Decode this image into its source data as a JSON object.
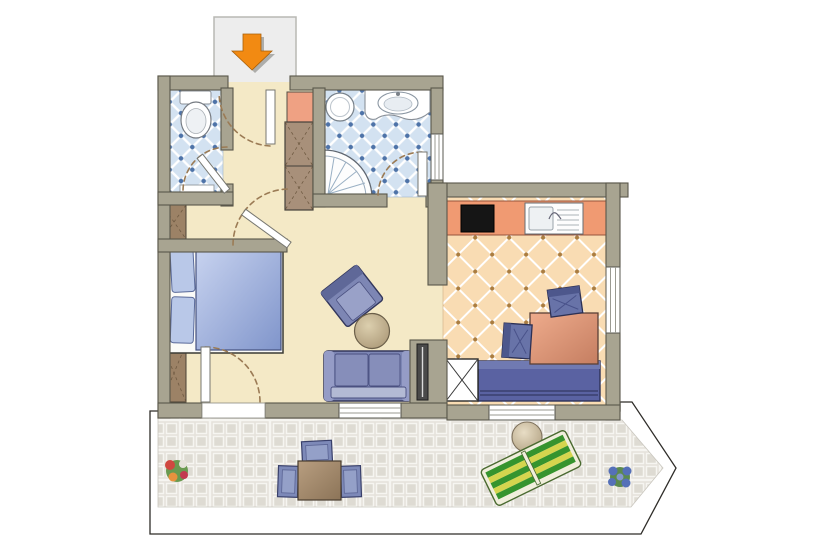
{
  "page": {
    "kind": "apartment-floor-plan",
    "background": "#ffffff"
  },
  "colors": {
    "wall": "#a8a491",
    "wall_edge": "#59574a",
    "floor_main": "#f4e9c6",
    "tile_blue": "#d3e2f1",
    "tile_blue_dot": "#4e73a8",
    "kitchen_floor": "#f9dcb3",
    "kitchen_dot": "#aa7d41",
    "terrace_tile": "#e5e2db",
    "terrace_grout": "#f6f5f1",
    "furniture_blue": "#7d86b4",
    "furniture_blue_dark": "#33375c",
    "bed_blue": "#9cadd9",
    "pillow_blue": "#b9c8e8",
    "closet_salmon": "#efa183",
    "counter_salmon": "#f09a72",
    "dining_table_salmon": "#d98e6d",
    "wood_brown": "#9c8266",
    "bench_blue": "#5a62a2",
    "lounger_green": "#36942e",
    "lounger_yellow": "#d4d54e",
    "arrow_orange": "#f28a12",
    "door_arc_brown": "#9b7b55",
    "radiator_gray": "#4a4a4a",
    "cooktop_black": "#151515",
    "fixture_white": "#ffffff",
    "plan_outline": "#2e2c28"
  },
  "entrance": {
    "icon": "entry-arrow-down-icon",
    "arrow_color": "#f28a12"
  },
  "rooms": [
    {
      "name": "wc",
      "floor": "blue-diamond-tile",
      "fixtures": [
        "toilet",
        "wall-shelf"
      ]
    },
    {
      "name": "hallway",
      "floor": "beige",
      "fixtures": [
        "closet-shelf",
        "wardrobe-cabinet"
      ]
    },
    {
      "name": "bathroom",
      "floor": "blue-diamond-tile",
      "fixtures": [
        "round-washbasin",
        "vanity-sink",
        "corner-shower"
      ]
    },
    {
      "name": "bedroom-living-studio",
      "floor": "beige",
      "furniture": [
        "wardrobe-upper",
        "wardrobe-lower",
        "double-bed",
        "pillow-left",
        "pillow-right",
        "armchair",
        "round-coffee-table",
        "two-seat-sofa",
        "radiator"
      ]
    },
    {
      "name": "kitchen-dining",
      "floor": "peach-diamond-tile",
      "furniture": [
        "kitchen-counter",
        "cooktop",
        "sink-with-drainer",
        "dining-table",
        "dining-chair-north",
        "dining-chair-west",
        "bench-daybed",
        "x-cabinet"
      ]
    },
    {
      "name": "terrace",
      "floor": "stone-pavers",
      "furniture": [
        "outdoor-table",
        "outdoor-chair-north",
        "outdoor-chair-west",
        "outdoor-chair-east",
        "round-side-table",
        "sun-lounger",
        "flower-pot-left",
        "flower-pot-right"
      ]
    }
  ],
  "doors": [
    "entrance-door",
    "wc-door",
    "bathroom-door",
    "bedroom-door",
    "terrace-door"
  ],
  "windows": [
    "living-south-window",
    "kitchen-south-window",
    "kitchen-east-window",
    "bathroom-east-window"
  ]
}
